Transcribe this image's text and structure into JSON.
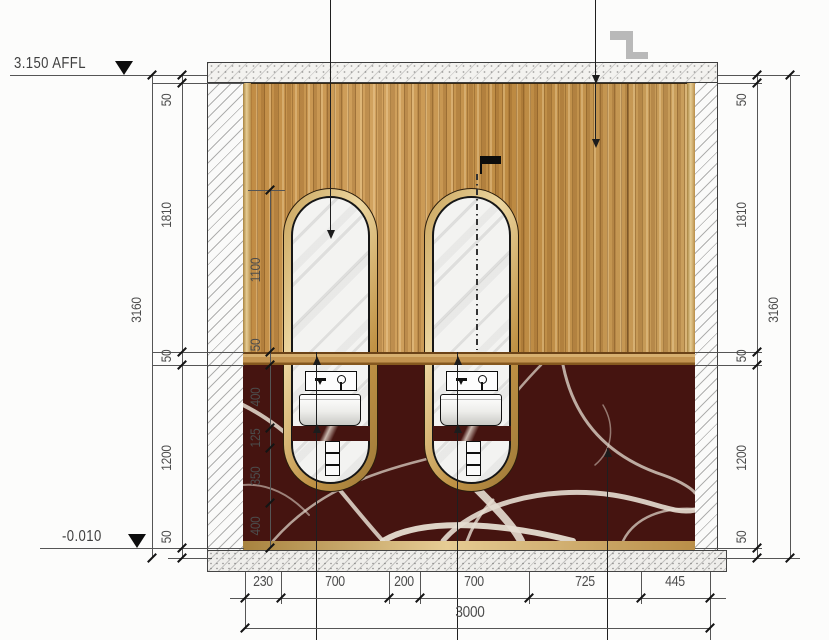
{
  "levels": {
    "top_label": "3.150 AFFL",
    "bottom_label": "-0.010"
  },
  "dims": {
    "left_overall": "3160",
    "left_segments": [
      "50",
      "1810",
      "50",
      "1200",
      "50"
    ],
    "right_overall": "3160",
    "right_segments": [
      "50",
      "1810",
      "50",
      "1200",
      "50"
    ],
    "mirror_chain": [
      "1100",
      "50",
      "400",
      "125",
      "350",
      "400"
    ],
    "bottom_segments": [
      "230",
      "700",
      "200",
      "700",
      "725",
      "445"
    ],
    "bottom_overall": "3000"
  },
  "materials": {
    "wood_panel": "#c6974f",
    "gold_trim": "#d8b878",
    "marble": "#451410",
    "marble_vein": "#e6ddd1",
    "mirror": "#f3f3f1",
    "dim_text": "#4c4c4c"
  },
  "icons": {
    "level_marker": "filled-triangle-down-icon",
    "faucet_spout": "spout-icon",
    "faucet_handle": "cross-handle-icon",
    "section_step": "gray-step-symbol-icon",
    "centerline_flag": "black-flag-icon"
  }
}
